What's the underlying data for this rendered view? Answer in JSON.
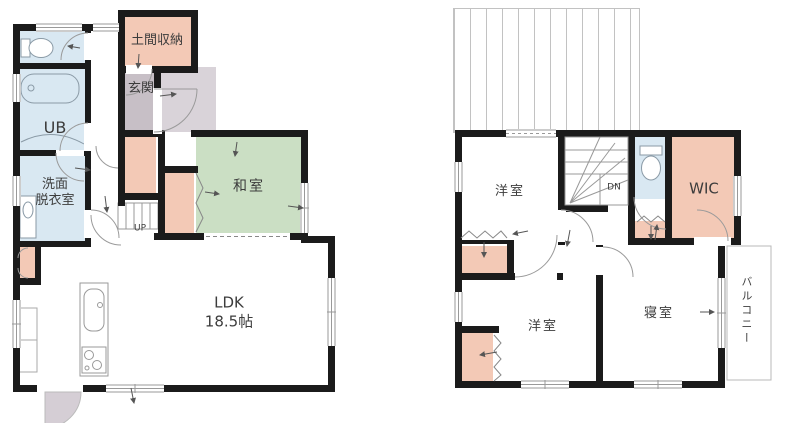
{
  "document": "floor-plan",
  "colors": {
    "wall": "#1b1b1b",
    "tatami_green": "#cbdfc4",
    "wet_area_blue": "#d9e8f2",
    "closet_salmon": "#f3c9b6",
    "entrance_gray": "#c7bfc6",
    "porch_gray": "#d9d3d9",
    "line_gray": "#999999",
    "text": "#3c3c3c"
  },
  "floor1": {
    "doma_label": "土間収納",
    "genkan_label": "玄関",
    "ub_label": "UB",
    "senmen_label": "洗面\n脱衣室",
    "washitsu_label": "和室",
    "ldk_label": "LDK\n18.5帖",
    "stairs_label": "UP"
  },
  "floor2": {
    "yoshitsu_a_label": "洋室",
    "yoshitsu_b_label": "洋室",
    "wic_label": "WIC",
    "shinshitsu_label": "寝室",
    "balcony_label": "バルコニー",
    "stairs_label": "DN"
  }
}
